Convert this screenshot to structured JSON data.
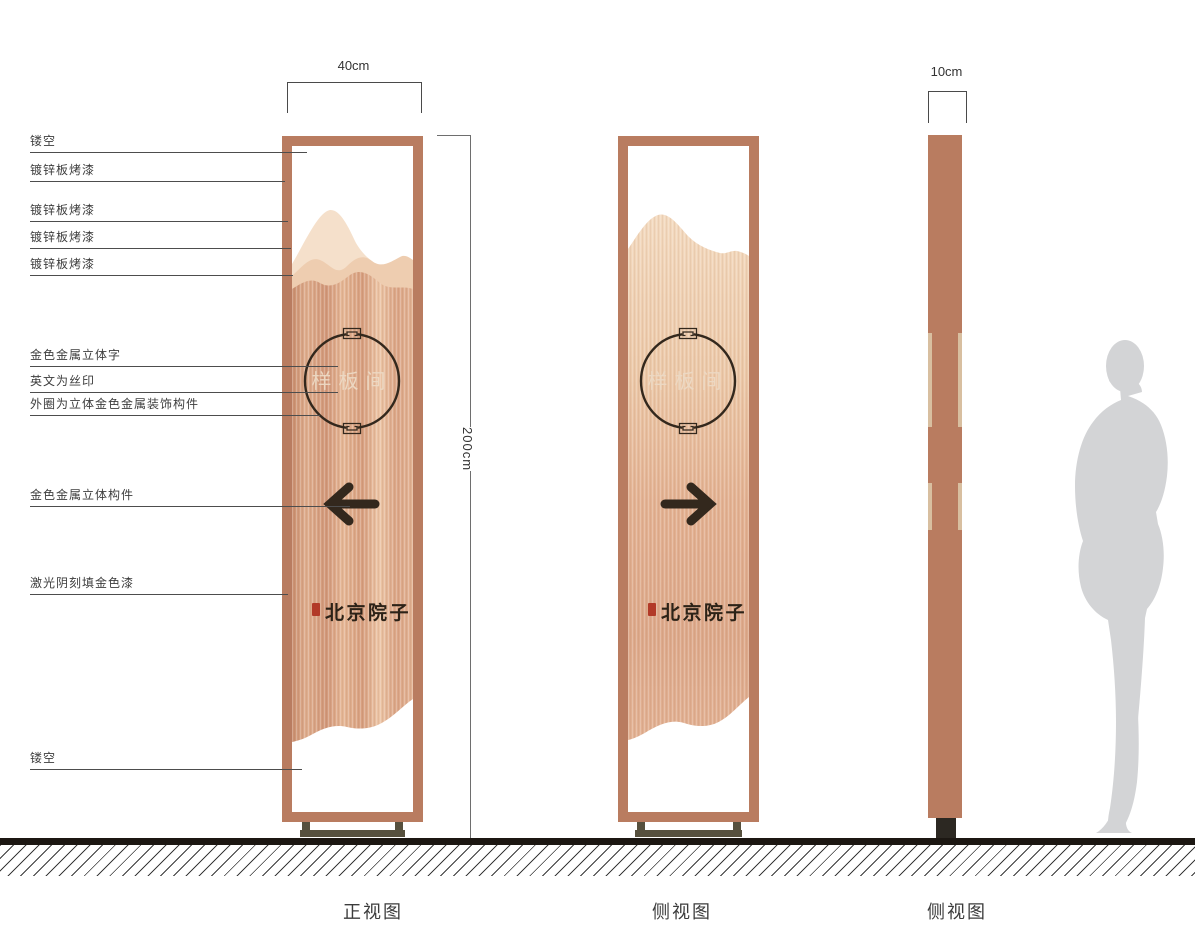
{
  "annotations": [
    "镂空",
    "镀锌板烤漆",
    "镀锌板烤漆",
    "镀锌板烤漆",
    "镀锌板烤漆",
    "金色金属立体字",
    "英文为丝印",
    "外圈为立体金色金属装饰构件",
    "金色金属立体构件",
    "激光阴刻填金色漆",
    "镂空"
  ],
  "dimensions": {
    "front_width": "40cm",
    "height": "200cm",
    "side_width": "10cm"
  },
  "sign": {
    "plate_text": "样板间",
    "logo_text": "北京院子"
  },
  "captions": {
    "front": "正视图",
    "side_back": "侧视图",
    "side_profile": "侧视图"
  },
  "colors": {
    "frame": "#b97c60",
    "panel_copper": "#dfa988",
    "accent_dark": "#33281d",
    "seal_red": "#b23a28",
    "base": "#56503e",
    "ground": "#1c1712",
    "silhouette": "#d3d4d6"
  }
}
